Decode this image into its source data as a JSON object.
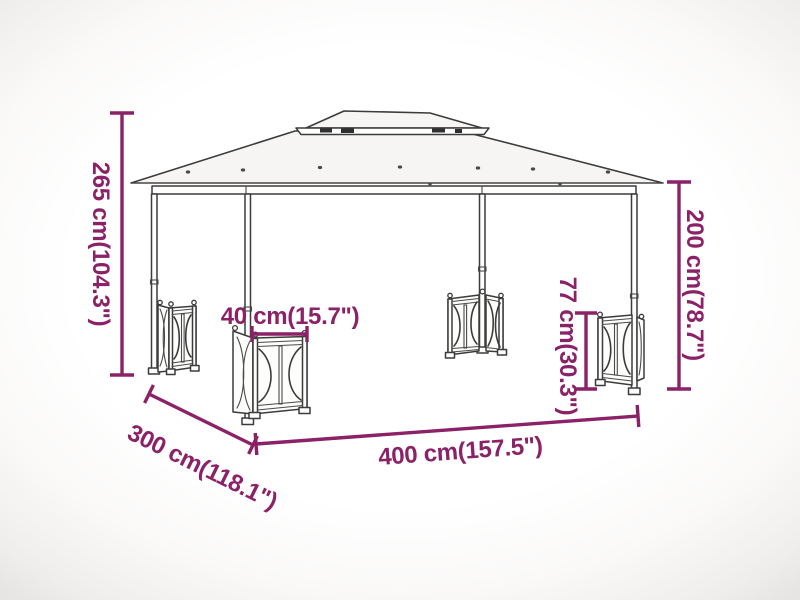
{
  "diagram": {
    "name": "gazebo-with-sidewalls-dimension-diagram",
    "dimensions": {
      "total_height": {
        "label": "265 cm(104.3\")",
        "value_cm": 265,
        "value_in": 104.3
      },
      "side_height": {
        "label": "200 cm(78.7\")",
        "value_cm": 200,
        "value_in": 78.7
      },
      "panel_height": {
        "label": "77 cm(30.3\")",
        "value_cm": 77,
        "value_in": 30.3
      },
      "panel_width": {
        "label": "40 cm(15.7\")",
        "value_cm": 40,
        "value_in": 15.7
      },
      "length": {
        "label": "400 cm(157.5\")",
        "value_cm": 400,
        "value_in": 157.5
      },
      "depth": {
        "label": "300 cm(118.1\")",
        "value_cm": 300,
        "value_in": 118.1
      }
    },
    "colors": {
      "dimension_accent": "#8b2167",
      "line_art": "#3c3c3c",
      "background": "#ffffff"
    }
  }
}
